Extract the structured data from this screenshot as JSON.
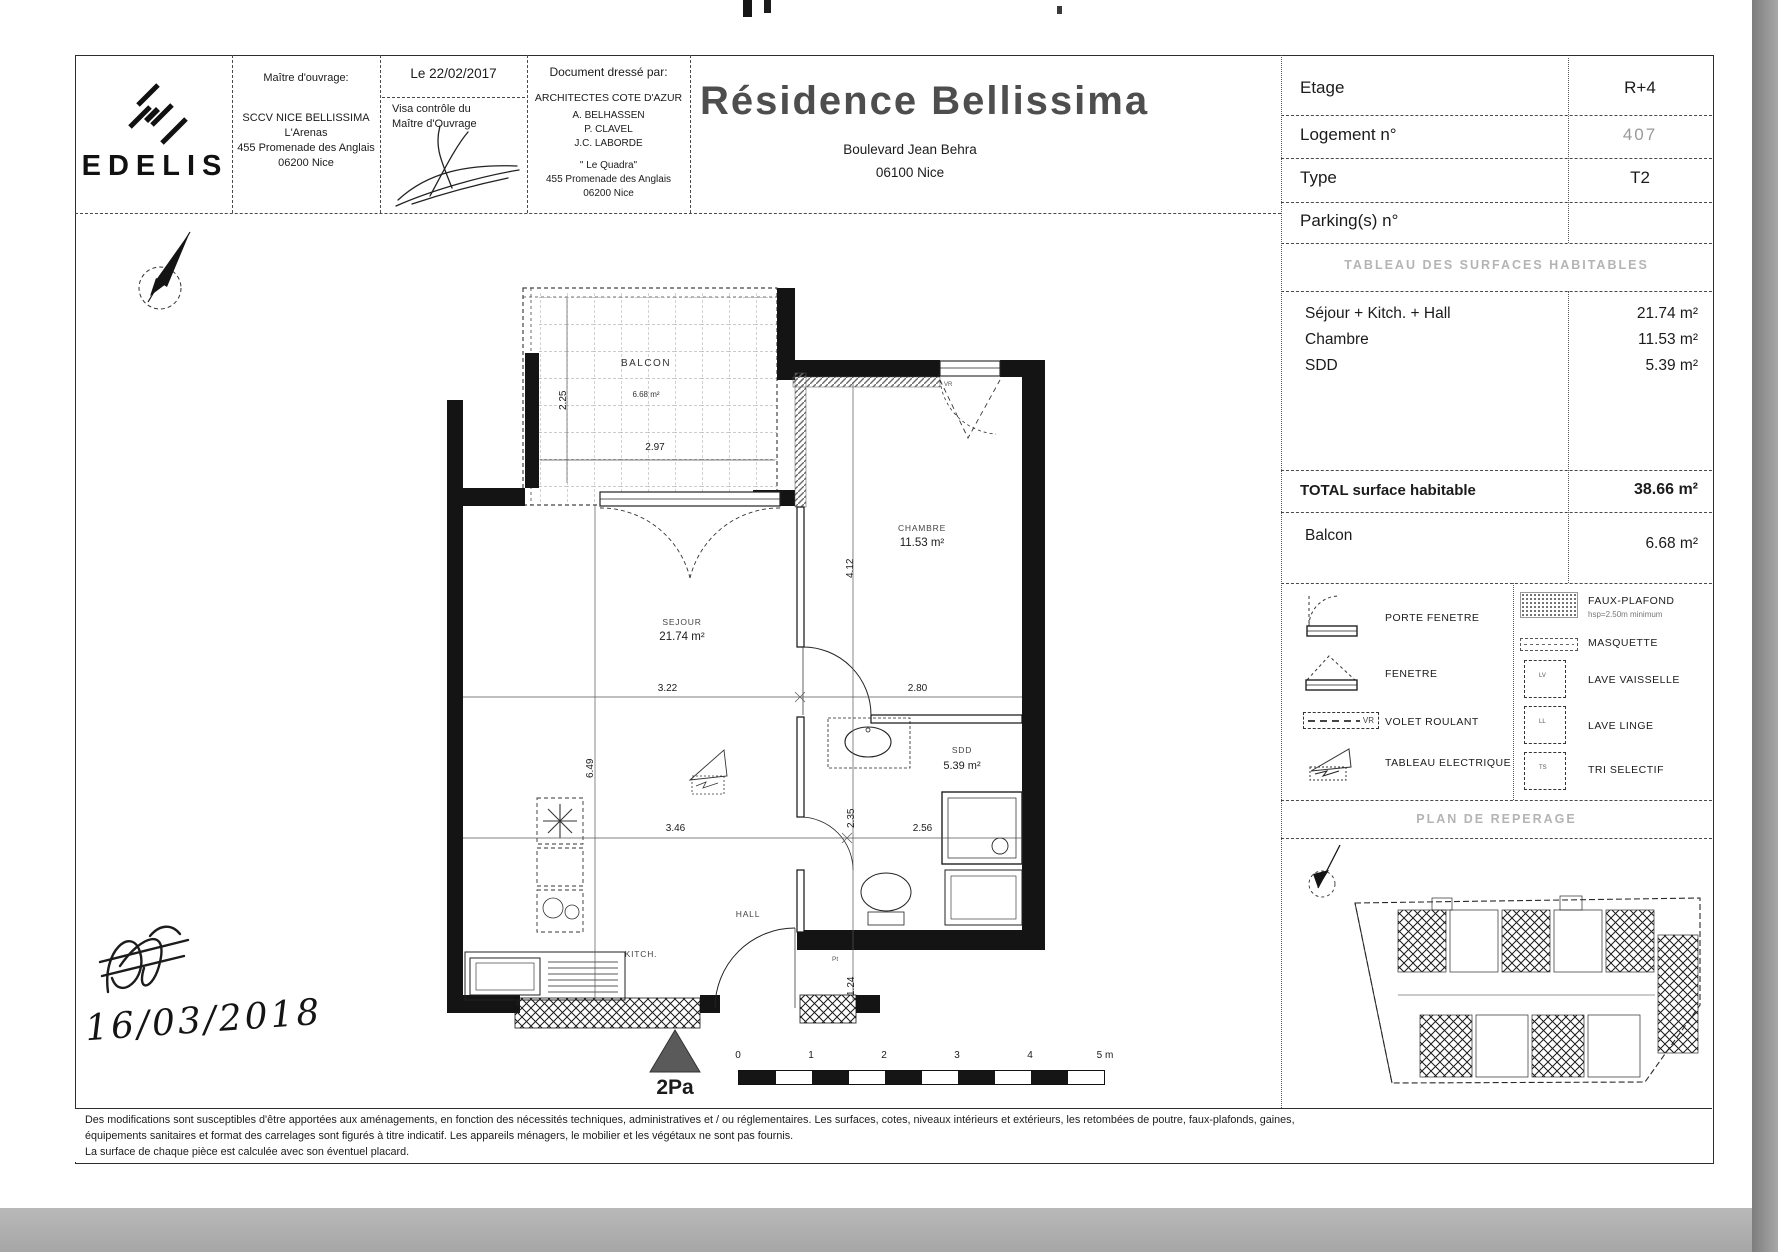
{
  "header": {
    "logo_text": "EDELIS",
    "owner": {
      "title": "Maître d'ouvrage:",
      "line1": "SCCV NICE BELLISSIMA",
      "line2": "L'Arenas",
      "line3": "455 Promenade des Anglais",
      "line4": "06200 Nice"
    },
    "visa": {
      "date": "Le 22/02/2017",
      "label_line1": "Visa contrôle du",
      "label_line2": "Maître d'Ouvrage"
    },
    "architect": {
      "title": "Document dressé par:",
      "firm": "ARCHITECTES COTE D'AZUR",
      "name1": "A. BELHASSEN",
      "name2": "P. CLAVEL",
      "name3": "J.C. LABORDE",
      "office": "\" Le Quadra\"",
      "addr1": "455 Promenade des Anglais",
      "addr2": "06200 Nice"
    },
    "title": {
      "main": "Résidence Bellissima",
      "street": "Boulevard Jean Behra",
      "city": "06100 Nice"
    }
  },
  "info": {
    "etage_label": "Etage",
    "etage_value": "R+4",
    "logement_label": "Logement n°",
    "logement_value": "407",
    "type_label": "Type",
    "type_value": "T2",
    "parking_label": "Parking(s) n°",
    "parking_value": ""
  },
  "surfaces": {
    "header": "TABLEAU DES SURFACES HABITABLES",
    "row1_label": "Séjour + Kitch. + Hall",
    "row1_value": "21.74 m²",
    "row2_label": "Chambre",
    "row2_value": "11.53 m²",
    "row3_label": "SDD",
    "row3_value": "5.39 m²",
    "total_label": "TOTAL surface habitable",
    "total_value": "38.66 m²",
    "balcon_label": "Balcon",
    "balcon_value": "6.68 m²"
  },
  "legend": {
    "porte_fenetre": "PORTE FENETRE",
    "fenetre": "FENETRE",
    "volet_roulant": "VOLET ROULANT",
    "volet_tag": "VR",
    "tableau_electrique": "TABLEAU ELECTRIQUE",
    "faux_plafond": "FAUX-PLAFOND",
    "faux_plafond_sub": "hsp=2.50m minimum",
    "masquette": "MASQUETTE",
    "lave_vaisselle": "LAVE VAISSELLE",
    "lave_vaisselle_tag": "LV",
    "lave_linge": "LAVE LINGE",
    "lave_linge_tag": "LL",
    "tri_selectif": "TRI SELECTIF",
    "tri_selectif_tag": "TS"
  },
  "reperage": {
    "header": "PLAN DE REPERAGE"
  },
  "plan": {
    "balcon_name": "BALCON",
    "balcon_area": "6.68 m²",
    "chambre_name": "CHAMBRE",
    "chambre_area": "11.53 m²",
    "sejour_name": "SEJOUR",
    "sejour_area": "21.74 m²",
    "sdd_name": "SDD",
    "sdd_area": "5.39 m²",
    "hall_name": "HALL",
    "kitch_name": "KITCH.",
    "vr_tag": "VR",
    "pt_tag": "Pt",
    "dim_balcon_h": "2.25",
    "dim_balcon_w": "2.97",
    "dim_chambre_h": "4.12",
    "dim_sejour_w": "3.22",
    "dim_chambre_w": "2.80",
    "dim_sejour_h": "6.49",
    "dim_kitchen_w": "3.46",
    "dim_sdd_h": "2.35",
    "dim_sdd_w": "2.56",
    "dim_entry_h": "1.24",
    "marker": "2Pa",
    "scale": {
      "t0": "0",
      "t1": "1",
      "t2": "2",
      "t3": "3",
      "t4": "4",
      "t5": "5 m"
    }
  },
  "annotation": {
    "handwritten_date": "16/03/2018"
  },
  "disclaimer": {
    "line1": "Des modifications sont susceptibles d'être apportées aux aménagements, en fonction des nécessités techniques, administratives et / ou réglementaires. Les surfaces, cotes, niveaux intérieurs et extérieurs, les retombées de poutre, faux-plafonds, gaines,",
    "line2": "équipements sanitaires et format des carrelages sont figurés à titre indicatif. Les appareils ménagers, le mobilier et les végétaux ne sont pas fournis.",
    "line3": "La surface de chaque pièce est calculée avec son éventuel placard."
  }
}
